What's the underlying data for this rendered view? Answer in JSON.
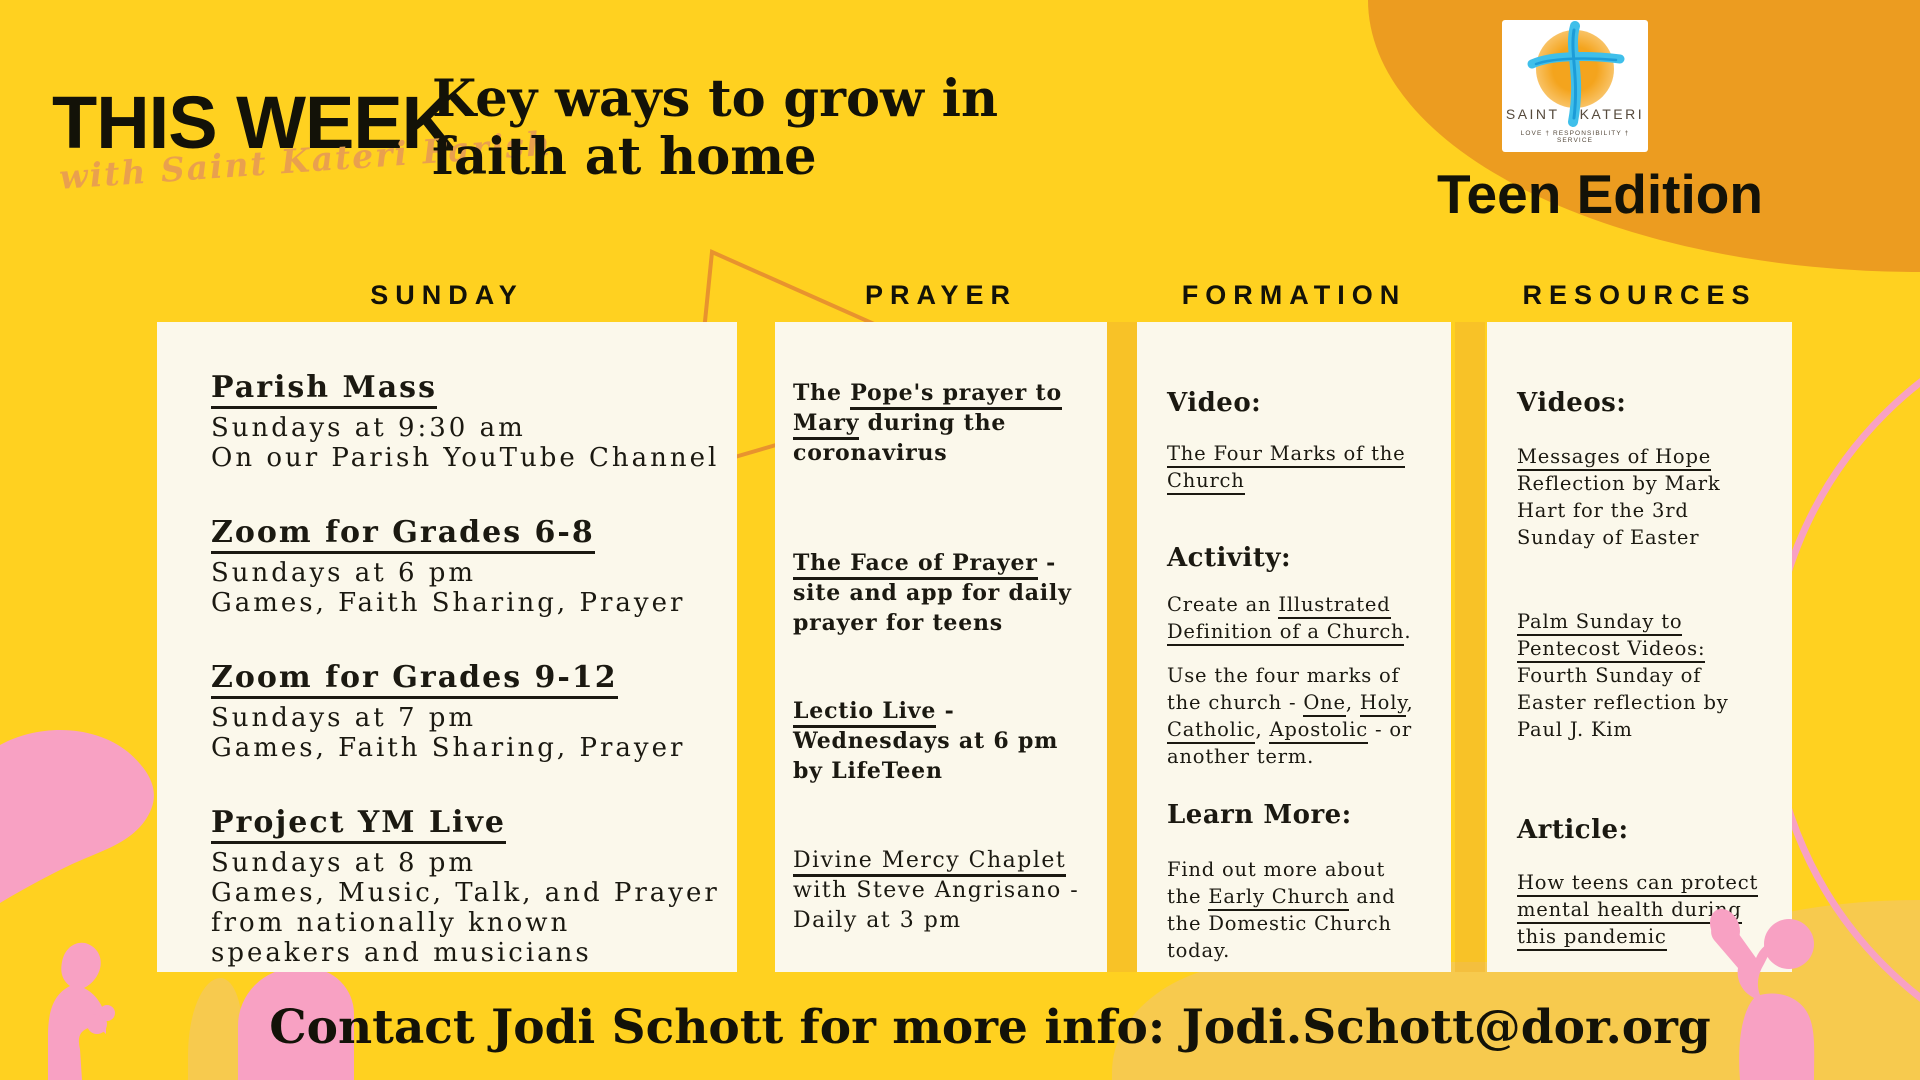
{
  "palette": {
    "background_yellow": "#FFD120",
    "corner_orange": "#EC9C20",
    "card_cream": "#FBF8EB",
    "decor_pink": "#F8A1C3",
    "pale_yellow": "#F7CA4E",
    "script_orange": "#E9A04E",
    "text_black": "#1B1911",
    "logo_blue": "#3FBFEA"
  },
  "header": {
    "title": "THIS WEEK",
    "script": "with Saint Kateri Parish",
    "tagline": "Key ways to grow in\nfaith at home",
    "edition": "Teen Edition",
    "logo": {
      "name_left": "SAINT",
      "name_right": "KATERI",
      "motto": "LOVE  †  RESPONSIBILITY  †  SERVICE"
    }
  },
  "columns": [
    {
      "header": "SUNDAY",
      "items": [
        {
          "title": "Parish Mass",
          "body": "Sundays at 9:30 am\nOn our Parish YouTube Channel"
        },
        {
          "title": "Zoom for Grades 6-8",
          "body": "Sundays at 6 pm\nGames, Faith Sharing, Prayer"
        },
        {
          "title": "Zoom for Grades 9-12",
          "body": "Sundays at 7 pm\nGames, Faith Sharing, Prayer"
        },
        {
          "title": "Project YM Live",
          "body": "Sundays at 8 pm\nGames, Music, Talk, and Prayer\nfrom nationally known\nspeakers and musicians"
        }
      ]
    },
    {
      "header": "PRAYER",
      "blocks": [
        {
          "segments": [
            {
              "t": "The ",
              "u": false
            },
            {
              "t": "Pope's prayer to\nMary",
              "u": true
            },
            {
              "t": " during the\ncoronavirus",
              "u": false
            }
          ]
        },
        {
          "segments": [
            {
              "t": "The Face of Prayer",
              "u": true
            },
            {
              "t": " -\nsite and app for daily\nprayer for teens",
              "u": false
            }
          ]
        },
        {
          "segments": [
            {
              "t": "Lectio Live",
              "u": true
            },
            {
              "t": " -\nWednesdays at 6 pm\nby LifeTeen",
              "u": false
            }
          ]
        },
        {
          "segments": [
            {
              "t": "Divine Mercy Chaplet",
              "u": true
            },
            {
              "t": "\nwith Steve Angrisano -\nDaily at 3 pm",
              "u": false
            }
          ]
        }
      ]
    },
    {
      "header": "FORMATION",
      "blocks": [
        {
          "heading": "Video:"
        },
        {
          "segments": [
            {
              "t": "The Four Marks of the\nChurch",
              "u": true
            }
          ]
        },
        {
          "heading": "Activity:"
        },
        {
          "segments": [
            {
              "t": "Create an ",
              "u": false
            },
            {
              "t": "Illustrated\nDefinition of a Church",
              "u": true
            },
            {
              "t": ".",
              "u": false
            }
          ]
        },
        {
          "segments": [
            {
              "t": "Use the four marks of\nthe church - ",
              "u": false
            },
            {
              "t": "One",
              "u": true
            },
            {
              "t": ", ",
              "u": false
            },
            {
              "t": "Holy",
              "u": true
            },
            {
              "t": ",\n",
              "u": false
            },
            {
              "t": "Catholic",
              "u": true
            },
            {
              "t": ", ",
              "u": false
            },
            {
              "t": "Apostolic",
              "u": true
            },
            {
              "t": " - or\nanother term.",
              "u": false
            }
          ]
        },
        {
          "heading": "Learn More:"
        },
        {
          "segments": [
            {
              "t": "Find out more about\nthe ",
              "u": false
            },
            {
              "t": "Early Church",
              "u": true
            },
            {
              "t": " and\nthe Domestic Church\ntoday.",
              "u": false
            }
          ]
        }
      ]
    },
    {
      "header": "RESOURCES",
      "blocks": [
        {
          "heading": "Videos:"
        },
        {
          "segments": [
            {
              "t": "Messages of Hope",
              "u": true
            },
            {
              "t": "\nReflection by Mark\nHart for the 3rd\nSunday of Easter",
              "u": false
            }
          ]
        },
        {
          "segments": [
            {
              "t": "Palm Sunday to\nPentecost Videos:",
              "u": true
            },
            {
              "t": "\nFourth Sunday of\nEaster reflection by\nPaul J. Kim",
              "u": false
            }
          ]
        },
        {
          "heading": "Article:"
        },
        {
          "segments": [
            {
              "t": "How teens can protect\nmental health during\nthis pandemic",
              "u": true
            }
          ]
        }
      ]
    }
  ],
  "footer": {
    "contact": "Contact Jodi Schott for more info: Jodi.Schott@dor.org"
  }
}
